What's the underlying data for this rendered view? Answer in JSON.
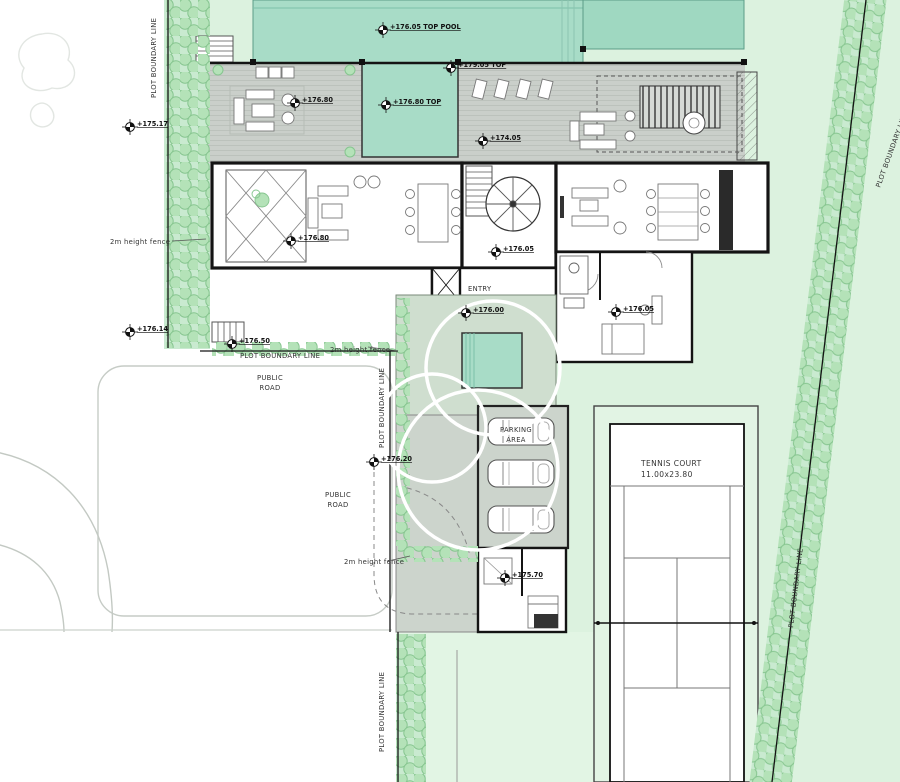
{
  "markers": [
    {
      "label": "+176.05 TOP POOL"
    },
    {
      "label": "+179.05 TOP"
    },
    {
      "label": "+176.80"
    },
    {
      "label": "+176.80 TOP"
    },
    {
      "label": "+174.05"
    },
    {
      "label": "+175.17"
    },
    {
      "label": "+176.80"
    },
    {
      "label": "+176.05"
    },
    {
      "label": "+176.14"
    },
    {
      "label": "+176.50"
    },
    {
      "label": "+176.00"
    },
    {
      "label": "+176.05"
    },
    {
      "label": "+176.20"
    },
    {
      "label": "+175.70"
    }
  ],
  "labels": {
    "plot_boundary": "PLOT BOUNDARY LINE",
    "fence": "2m height fence",
    "road_line1": "PUBLIC",
    "road_line2": "ROAD",
    "entry": "ENTRY",
    "parking_line1": "PARKING",
    "parking_line2": "AREA",
    "tennis_line1": "TENNIS COURT",
    "tennis_line2": "11.00x23.80"
  },
  "colors": {
    "lawn": "#dcf2df",
    "pool": "#a8dcc7",
    "pool2": "#9fd8c1",
    "deck": "#cacfca",
    "terrace": "#cfdecf",
    "paving": "#ccd4cc",
    "tree_fill": "#b4e2b8",
    "tree_edge": "#86c58f",
    "wall": "#141414"
  }
}
